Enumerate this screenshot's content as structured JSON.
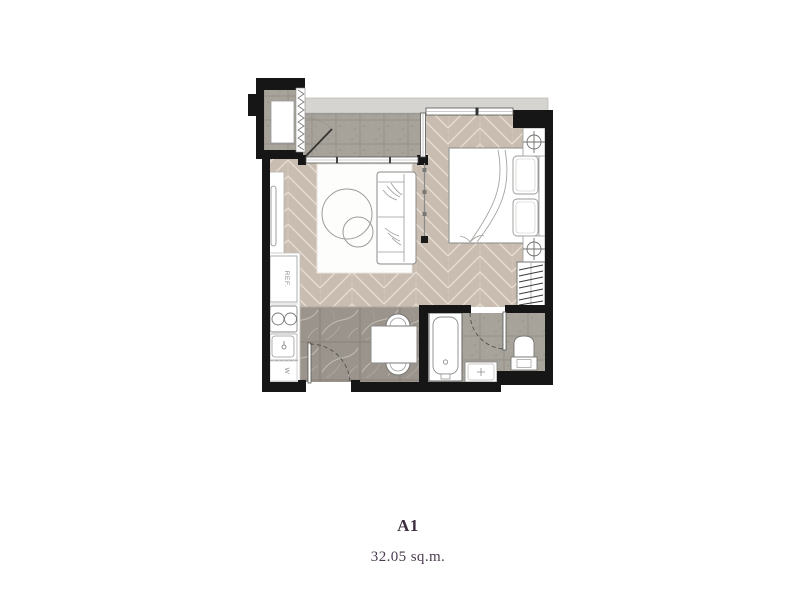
{
  "plan": {
    "unit_name": "A1",
    "unit_area": "32.05 sq.m.",
    "labels": {
      "refrigerator": "REF.",
      "washer": "W"
    },
    "colors": {
      "wall": "#161616",
      "wood_floor": "#c9bcb0",
      "wood_joint": "#e6ddd2",
      "tile_floor": "#a7a39b",
      "marble_floor": "#9a948c",
      "ledge": "#d5d4d0",
      "title_text": "#3c2d3f",
      "area_text": "#4b3c50"
    }
  }
}
